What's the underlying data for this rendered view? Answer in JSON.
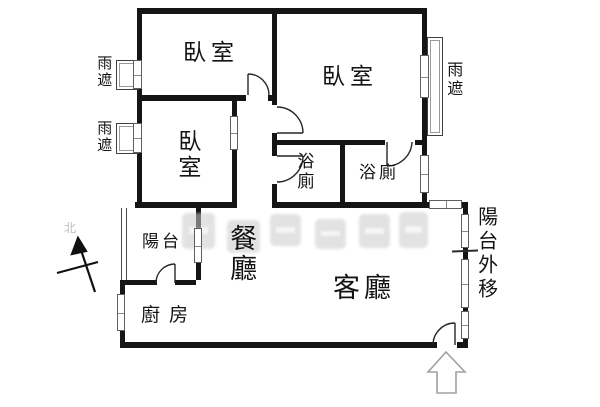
{
  "plan": {
    "type": "apartment-floor-plan",
    "labels": {
      "bedroom_top_left": "臥室",
      "bedroom_top_right": "臥室",
      "bedroom_mid_left": "臥室",
      "bath_left": "浴廁",
      "bath_right": "浴廁",
      "balcony": "陽台",
      "dining": "餐廳",
      "living": "客廳",
      "kitchen": "廚房",
      "balcony_extended": "陽台外移",
      "rain_cover_left_top": "雨遮",
      "rain_cover_left_bottom": "雨遮",
      "rain_cover_right": "雨遮",
      "north": "北"
    },
    "colors": {
      "wall": "#151515",
      "window_border": "#5f5f5f",
      "watermark": "#cbcbcb",
      "entry_arrow_outline": "#a0a0a0"
    },
    "symbols": {
      "compass": "north-arrow",
      "entrance": "hollow-up-arrow"
    }
  }
}
